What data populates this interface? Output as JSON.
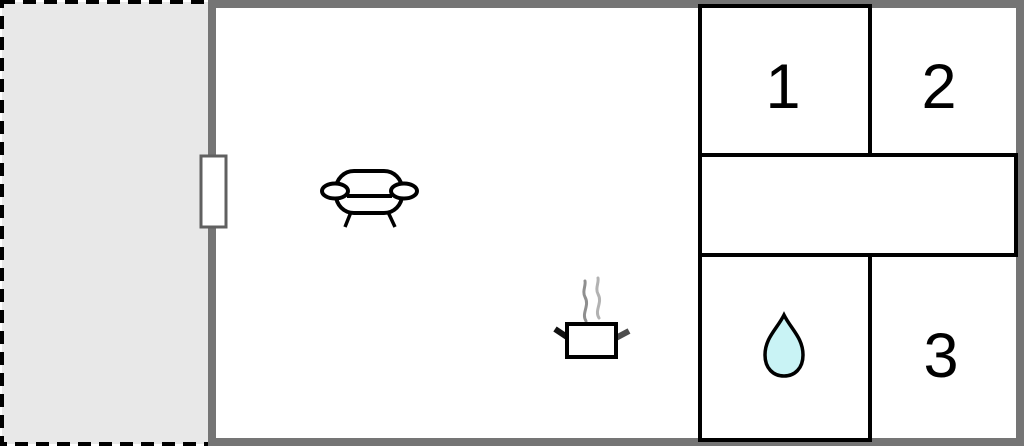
{
  "floor_plan": {
    "room_labels": {
      "room1": "1",
      "room2": "2",
      "room3": "3"
    },
    "icons": [
      {
        "name": "sofa-icon",
        "area": "living-room"
      },
      {
        "name": "steam-icon",
        "area": "living-room"
      },
      {
        "name": "cooking-pot-icon",
        "area": "living-room"
      },
      {
        "name": "water-drop-icon",
        "area": "bathroom"
      },
      {
        "name": "window-door-icon",
        "area": "left-wall"
      }
    ],
    "colors": {
      "wall": "#757575",
      "terrace_fill": "#e8e8e8",
      "room_fill": "#ffffff",
      "outline": "#000000",
      "water_drop_fill": "#c9f3f5",
      "steam_dark": "#8f8f8f",
      "steam_light": "#b2b2b2",
      "door_frame": "#606060"
    }
  }
}
